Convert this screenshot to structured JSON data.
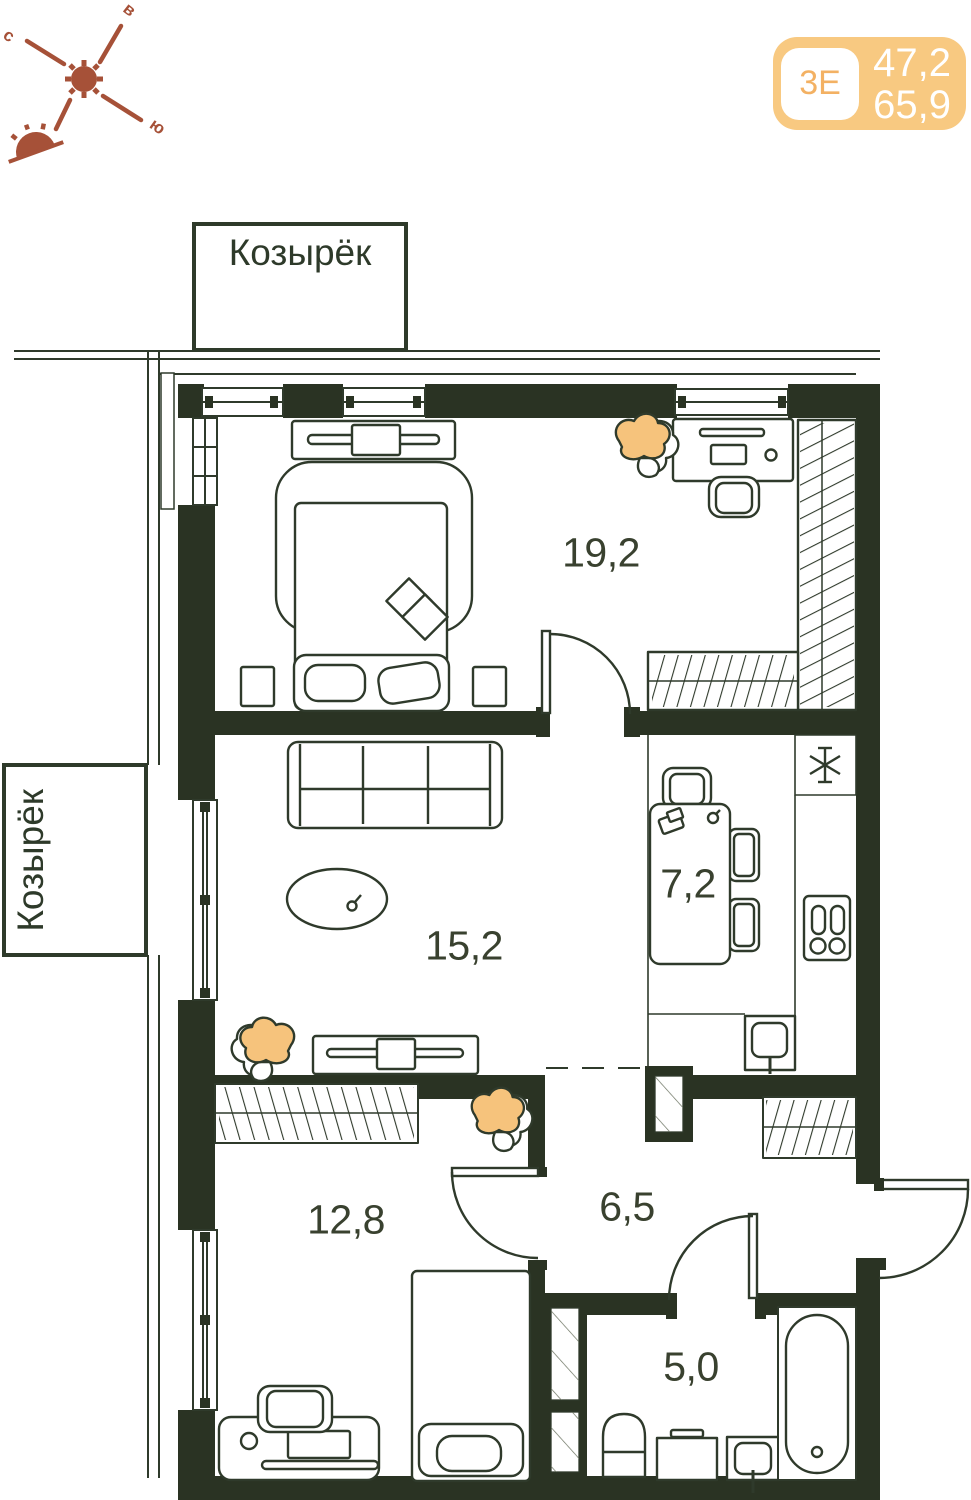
{
  "badge": {
    "type_label": "3Е",
    "area_top": "47,2",
    "area_bottom": "65,9",
    "bg_color": "#f8c981",
    "chip_text_color": "#f3b163",
    "numbers_color": "#ffffff"
  },
  "compass": {
    "north_label": "с",
    "east_label": "в",
    "south_label": "ю",
    "color": "#a65138"
  },
  "canopy": {
    "top_label": "Козырёк",
    "left_label": "Козырёк"
  },
  "rooms": [
    {
      "name": "bedroom-main",
      "area_label": "19,2"
    },
    {
      "name": "living-room",
      "area_label": "15,2"
    },
    {
      "name": "kitchen",
      "area_label": "7,2"
    },
    {
      "name": "bedroom-second",
      "area_label": "12,8"
    },
    {
      "name": "hallway",
      "area_label": "6,5"
    },
    {
      "name": "bathroom",
      "area_label": "5,0"
    }
  ],
  "colors": {
    "wall": "#2a3323",
    "line": "#2f3a2b",
    "label": "#39412f",
    "plant": "#f6c37c"
  }
}
